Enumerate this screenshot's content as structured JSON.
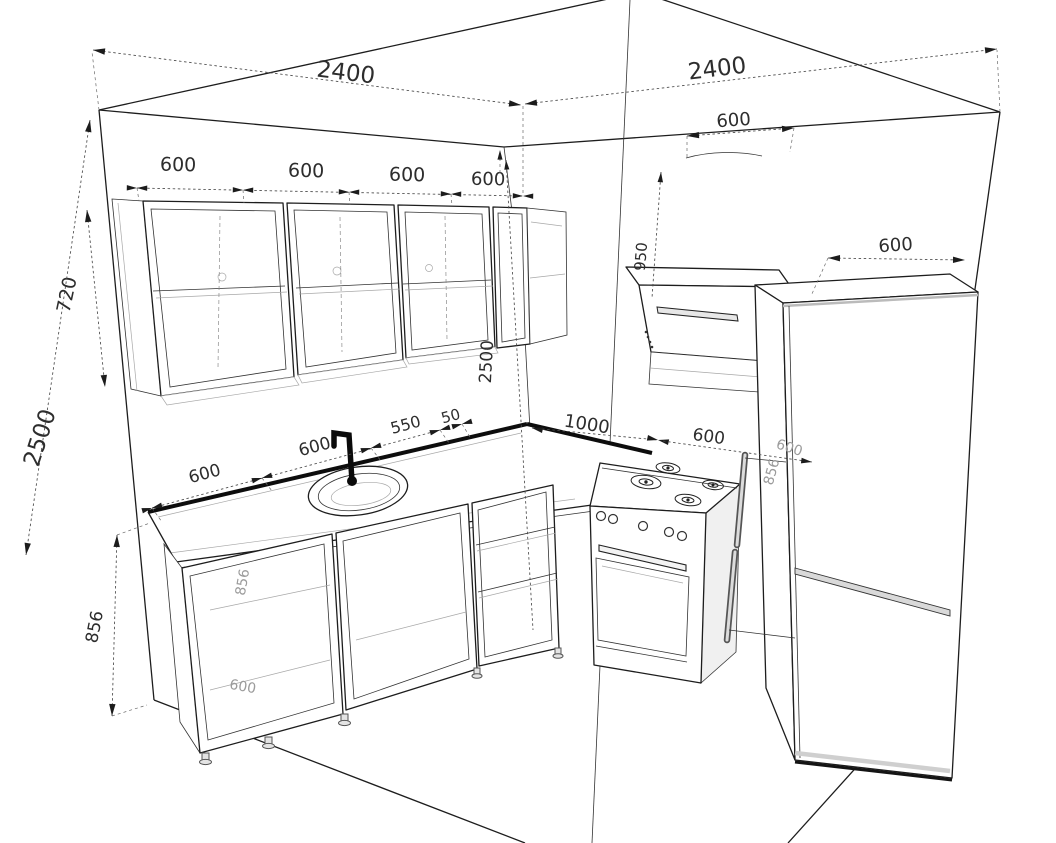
{
  "drawing": {
    "kind": "kitchen-corner-3d-dimension-drawing",
    "units": "mm",
    "line_color": "#1d1d1d",
    "background": "#ffffff"
  },
  "dimensions": {
    "left_wall_total": "2400",
    "right_wall_total": "2400",
    "upper_cab_1": "600",
    "upper_cab_2": "600",
    "upper_cab_3": "600",
    "upper_cab_4": "600",
    "upper_cab_height": "720",
    "wall_height_left": "2500",
    "wall_height_corner": "2500",
    "base_height": "856",
    "counter_seg_1": "600",
    "counter_seg_2": "600",
    "counter_seg_3": "550",
    "counter_seg_4": "50",
    "corner_to_stove": "1000",
    "stove_width": "600",
    "hood_width": "600",
    "hood_clearance": "950",
    "fridge_width": "600"
  },
  "ghost_dimensions": {
    "base_cab_height": "856",
    "base_cab_width": "600",
    "hidden_cab_width": "600",
    "hidden_cab_height": "856"
  }
}
